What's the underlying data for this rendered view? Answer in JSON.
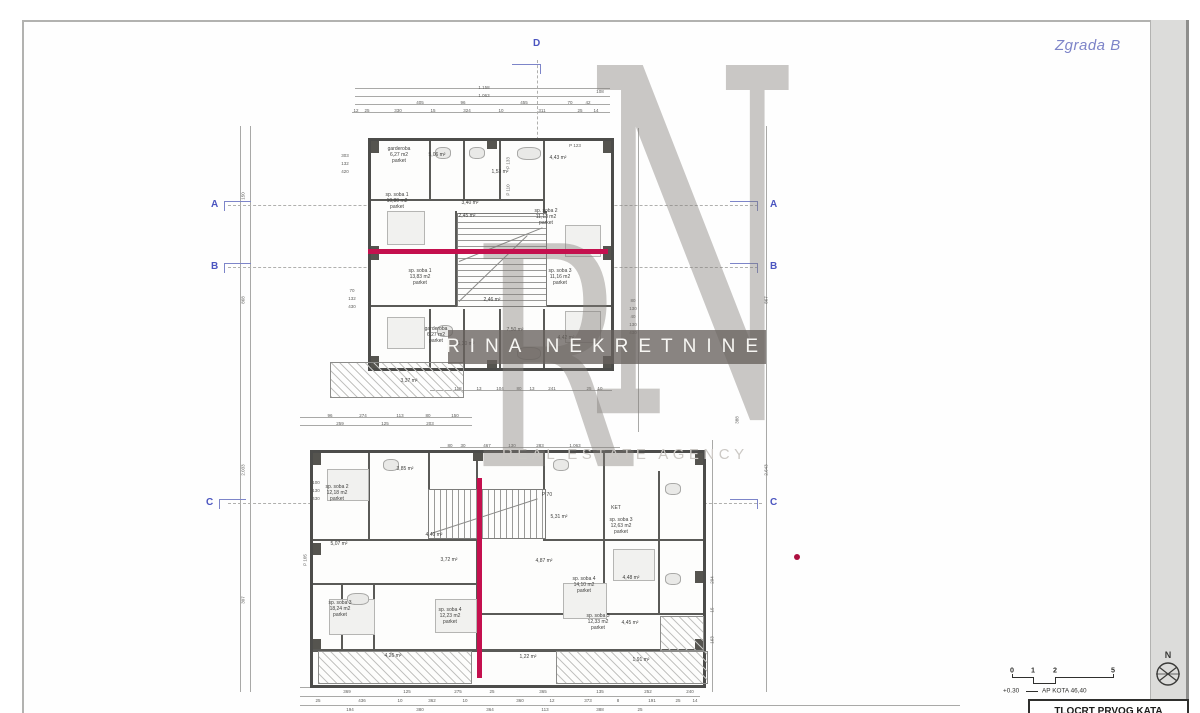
{
  "header": {
    "building_label": "Zgrada B"
  },
  "watermark": {
    "letter_r": "R",
    "letter_n": "N",
    "banner": "RINA NEKRETNINE",
    "subtitle": "REAL ESTATE AGENCY"
  },
  "colors": {
    "accent_magenta": "#c4104e",
    "marker_blue": "#4b55c0",
    "building_label_blue": "#7d84c8",
    "watermark_band": "#6e6862"
  },
  "legend": {
    "north_label": "N",
    "elevation": "+0.30",
    "kota_note": "AP KOTA 46,40",
    "title_block": "TLOCRT PRVOG KATA",
    "scale_ticks": [
      {
        "t": "0",
        "x": 1012
      },
      {
        "t": "1",
        "x": 1033
      },
      {
        "t": "2",
        "x": 1055
      },
      {
        "t": "5",
        "x": 1113
      }
    ]
  },
  "section_markers": [
    {
      "label": "D",
      "x": 533,
      "y": 38,
      "type": "top"
    },
    {
      "label": "A",
      "x": 211,
      "y": 199,
      "type": "left"
    },
    {
      "label": "A",
      "x": 770,
      "y": 199,
      "type": "right"
    },
    {
      "label": "B",
      "x": 211,
      "y": 261,
      "type": "left"
    },
    {
      "label": "B",
      "x": 770,
      "y": 261,
      "type": "right"
    },
    {
      "label": "C",
      "x": 206,
      "y": 497,
      "type": "left"
    },
    {
      "label": "C",
      "x": 770,
      "y": 497,
      "type": "right"
    }
  ],
  "rooms": [
    [
      "garderoba\n6,27 m2\nparket",
      399,
      146
    ],
    [
      "5,06 m²",
      437,
      152
    ],
    [
      "1,53 m²",
      500,
      169
    ],
    [
      "4,43 m²",
      558,
      155
    ],
    [
      "sp. soba 1\n10,80 m2\nparket",
      397,
      192
    ],
    [
      "3,40 m²",
      470,
      200
    ],
    [
      "2,45 m²",
      467,
      213
    ],
    [
      "sp. soba 2\n11,13 m2\nparket",
      546,
      208
    ],
    [
      "sp. soba 1\n13,83 m2\nparket",
      420,
      268
    ],
    [
      "sp. soba 3\n11,16 m2\nparket",
      560,
      268
    ],
    [
      "2,46 m²",
      492,
      297
    ],
    [
      "garderoba\n6,27 m2\nparket",
      436,
      326
    ],
    [
      "5,30 m²",
      466,
      341
    ],
    [
      "7,50 m²",
      515,
      327
    ],
    [
      "4,42 m²",
      566,
      335
    ],
    [
      "3,37 m²",
      409,
      378
    ],
    [
      "sp. soba 2\n12,18 m2\nparket",
      337,
      484
    ],
    [
      "3,85 m²",
      405,
      466
    ],
    [
      "P 70",
      547,
      492
    ],
    [
      "5,07 m²",
      339,
      541
    ],
    [
      "4,40 m²",
      434,
      532
    ],
    [
      "3,72 m²",
      449,
      557
    ],
    [
      "4,87 m²",
      544,
      558
    ],
    [
      "5,31 m²",
      559,
      514
    ],
    [
      "KET",
      616,
      505
    ],
    [
      "sp. soba 3\n12,63 m2\nparket",
      621,
      517
    ],
    [
      "sp. soba 3\n18,24 m2\nparket",
      340,
      600
    ],
    [
      "sp. soba 4\n12,23 m2\nparket",
      450,
      607
    ],
    [
      "sp. soba 3\n12,33 m2\nparket",
      598,
      613
    ],
    [
      "sp. soba 4\n14,10 m2\nparket",
      584,
      576
    ],
    [
      "4,48 m²",
      631,
      575
    ],
    [
      "4,45 m²",
      630,
      620
    ],
    [
      "4,26 m²",
      393,
      653
    ],
    [
      "1,22 m²",
      528,
      654
    ],
    [
      "1,91 m²",
      641,
      657
    ]
  ],
  "dims": [
    [
      "1.158",
      484,
      85,
      0
    ],
    [
      "1.063",
      484,
      93,
      0
    ],
    [
      "108",
      600,
      89,
      0
    ],
    [
      "405",
      420,
      100,
      0
    ],
    [
      "96",
      463,
      100,
      0
    ],
    [
      "455",
      524,
      100,
      0
    ],
    [
      "70",
      570,
      100,
      0
    ],
    [
      "42",
      588,
      100,
      0
    ],
    [
      "12",
      356,
      108,
      0
    ],
    [
      "25",
      367,
      108,
      0
    ],
    [
      "330",
      398,
      108,
      0
    ],
    [
      "15",
      433,
      108,
      0
    ],
    [
      "324",
      467,
      108,
      0
    ],
    [
      "10",
      501,
      108,
      0
    ],
    [
      "311",
      542,
      108,
      0
    ],
    [
      "25",
      580,
      108,
      0
    ],
    [
      "14",
      596,
      108,
      0
    ],
    [
      "150",
      243,
      196,
      1
    ],
    [
      "868",
      243,
      300,
      1
    ],
    [
      "2.033",
      243,
      470,
      1
    ],
    [
      "307",
      243,
      600,
      1
    ],
    [
      "303",
      345,
      153,
      0
    ],
    [
      "132",
      345,
      161,
      0
    ],
    [
      "420",
      345,
      169,
      0
    ],
    [
      "70",
      352,
      288,
      0
    ],
    [
      "132",
      352,
      296,
      0
    ],
    [
      "430",
      352,
      304,
      0
    ],
    [
      "80",
      633,
      298,
      0
    ],
    [
      "130",
      633,
      306,
      0
    ],
    [
      "40",
      633,
      314,
      0
    ],
    [
      "130",
      633,
      322,
      0
    ],
    [
      "430",
      633,
      330,
      0
    ],
    [
      "P 133",
      508,
      163,
      1
    ],
    [
      "P 110",
      508,
      190,
      1
    ],
    [
      "P 123",
      575,
      143,
      0
    ],
    [
      "867",
      766,
      300,
      1
    ],
    [
      "2.643",
      766,
      470,
      1
    ],
    [
      "388",
      737,
      420,
      1
    ],
    [
      "118",
      458,
      386,
      0
    ],
    [
      "13",
      479,
      386,
      0
    ],
    [
      "104",
      500,
      386,
      0
    ],
    [
      "80",
      519,
      386,
      0
    ],
    [
      "13",
      532,
      386,
      0
    ],
    [
      "241",
      552,
      386,
      0
    ],
    [
      "25",
      589,
      386,
      0
    ],
    [
      "10",
      600,
      386,
      0
    ],
    [
      "96",
      330,
      413,
      0
    ],
    [
      "274",
      363,
      413,
      0
    ],
    [
      "113",
      400,
      413,
      0
    ],
    [
      "80",
      428,
      413,
      0
    ],
    [
      "150",
      455,
      413,
      0
    ],
    [
      "259",
      340,
      421,
      0
    ],
    [
      "125",
      385,
      421,
      0
    ],
    [
      "203",
      430,
      421,
      0
    ],
    [
      "80",
      450,
      443,
      0
    ],
    [
      "30",
      463,
      443,
      0
    ],
    [
      "467",
      487,
      443,
      0
    ],
    [
      "130",
      512,
      443,
      0
    ],
    [
      "283",
      540,
      443,
      0
    ],
    [
      "1.063",
      575,
      443,
      0
    ],
    [
      "100",
      316,
      480,
      0
    ],
    [
      "130",
      316,
      488,
      0
    ],
    [
      "430",
      316,
      496,
      0
    ],
    [
      "P 105",
      305,
      560,
      1
    ],
    [
      "294",
      712,
      580,
      1
    ],
    [
      "15",
      712,
      610,
      1
    ],
    [
      "163",
      712,
      640,
      1
    ],
    [
      "369",
      347,
      689,
      0
    ],
    [
      "125",
      407,
      689,
      0
    ],
    [
      "275",
      458,
      689,
      0
    ],
    [
      "25",
      492,
      689,
      0
    ],
    [
      "365",
      543,
      689,
      0
    ],
    [
      "135",
      600,
      689,
      0
    ],
    [
      "252",
      648,
      689,
      0
    ],
    [
      "240",
      690,
      689,
      0
    ],
    [
      "25",
      318,
      698,
      0
    ],
    [
      "436",
      362,
      698,
      0
    ],
    [
      "10",
      400,
      698,
      0
    ],
    [
      "362",
      432,
      698,
      0
    ],
    [
      "10",
      465,
      698,
      0
    ],
    [
      "360",
      520,
      698,
      0
    ],
    [
      "12",
      552,
      698,
      0
    ],
    [
      "373",
      588,
      698,
      0
    ],
    [
      "8",
      618,
      698,
      0
    ],
    [
      "191",
      652,
      698,
      0
    ],
    [
      "25",
      678,
      698,
      0
    ],
    [
      "14",
      695,
      698,
      0
    ],
    [
      "194",
      350,
      707,
      0
    ],
    [
      "380",
      420,
      707,
      0
    ],
    [
      "364",
      490,
      707,
      0
    ],
    [
      "113",
      545,
      707,
      0
    ],
    [
      "388",
      600,
      707,
      0
    ],
    [
      "25",
      640,
      707,
      0
    ]
  ]
}
